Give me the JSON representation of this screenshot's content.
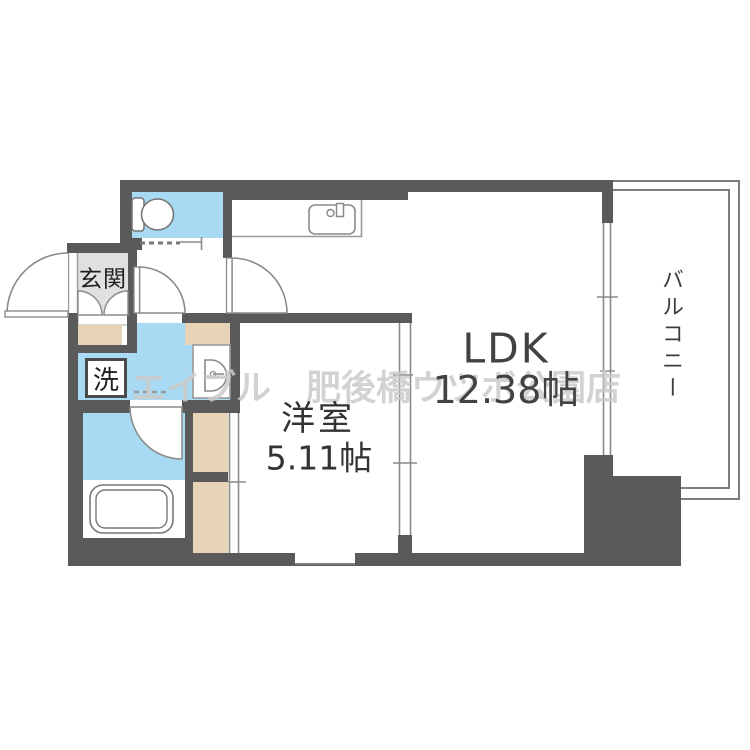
{
  "floorplan": {
    "watermark": "エイブル　肥後橋ウツボ公園店",
    "rooms": {
      "ldk": {
        "label": "LDK",
        "size": "12.38帖"
      },
      "bedroom": {
        "label": "洋室",
        "size": "5.11帖"
      },
      "balcony": {
        "label": "バルコニー"
      },
      "entrance": {
        "label": "玄関"
      },
      "laundry": {
        "label": "洗"
      }
    },
    "colors": {
      "wall": "#5a5a5a",
      "wet_room_blue": "#a9daf3",
      "closet_beige": "#e7d3b6",
      "entrance_gray": "#e0e0e0",
      "outline_gray": "#8a8a8a",
      "watermark_gray": "#cbcbcb"
    }
  }
}
